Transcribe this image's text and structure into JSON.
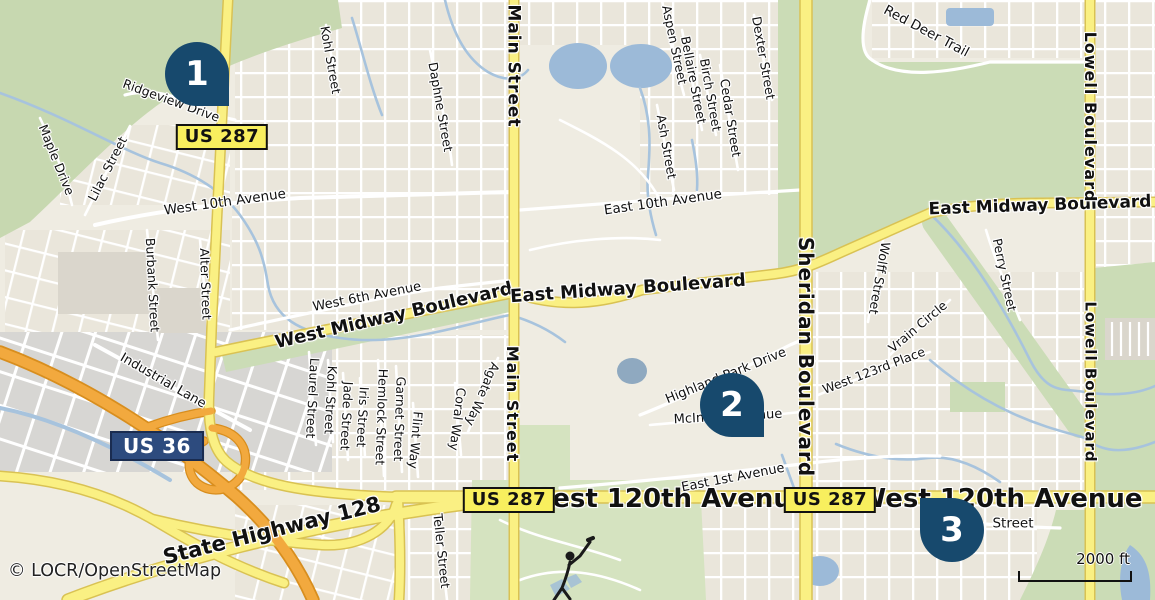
{
  "map": {
    "attribution": "© LOCR/OpenStreetMap",
    "scale_bar": {
      "label": "2000 ft"
    },
    "icons": {
      "golfer": "golfer-silhouette"
    },
    "colors": {
      "land": "#EFECE2",
      "forest": "#C7D8B0",
      "park": "#CBDCB6",
      "golf": "#D5E3C0",
      "water": "#9CBAD8",
      "stream": "#A7C3DD",
      "road_fill": "#FAF083",
      "road_casing": "#D9C253",
      "freeway_fill": "#F2A93E",
      "freeway_casing": "#D88E1E",
      "minor_road": "#FFFFFF",
      "industrial": "#D7D6D3",
      "building": "#DAD6CC",
      "marker": "#17496D",
      "marker_text": "#FFFFFF",
      "shield_yellow_bg": "#F8EF5E",
      "shield_yellow_border": "#111111",
      "shield_yellow_text": "#111111",
      "shield_blue_bg": "#2D4B7E",
      "shield_blue_border": "#1A2C50",
      "shield_blue_text": "#FFFFFF",
      "label": "#111111",
      "halo": "#FFFFFF",
      "attribution": "#222222"
    },
    "markers": [
      {
        "number": "1",
        "x": 197,
        "y": 74,
        "tail": "bottom-right"
      },
      {
        "number": "2",
        "x": 732,
        "y": 405,
        "tail": "bottom-right"
      },
      {
        "number": "3",
        "x": 952,
        "y": 530,
        "tail": "top-left"
      }
    ],
    "shields": [
      {
        "text": "US 287",
        "type": "us-287",
        "x": 222,
        "y": 137
      },
      {
        "text": "US 36",
        "type": "us-36",
        "x": 157,
        "y": 446
      },
      {
        "text": "US 287",
        "type": "us-287",
        "x": 509,
        "y": 500
      },
      {
        "text": "US 287",
        "type": "us-287",
        "x": 830,
        "y": 500
      }
    ],
    "labels": [
      {
        "text": "West 120th Avenue",
        "x": 667,
        "y": 499,
        "r": 0,
        "s": 26,
        "w": 700
      },
      {
        "text": "West 120th Avenue",
        "x": 1000,
        "y": 499,
        "r": 0,
        "s": 26,
        "w": 700
      },
      {
        "text": "State Highway 128",
        "x": 272,
        "y": 531,
        "r": -14,
        "s": 21,
        "w": 700
      },
      {
        "text": "West Midway Boulevard",
        "x": 394,
        "y": 316,
        "r": -13,
        "s": 18,
        "w": 600
      },
      {
        "text": "East Midway Boulevard",
        "x": 628,
        "y": 289,
        "r": -4,
        "s": 18,
        "w": 600
      },
      {
        "text": "East Midway Boulevard",
        "x": 1040,
        "y": 206,
        "r": -2,
        "s": 17,
        "w": 600
      },
      {
        "text": "Main Street",
        "x": 513,
        "y": 66,
        "r": 90,
        "s": 17,
        "w": 600,
        "ls": 1
      },
      {
        "text": "Main Street",
        "x": 512,
        "y": 404,
        "r": 90,
        "s": 16,
        "w": 600,
        "ls": 1
      },
      {
        "text": "Sheridan Boulevard",
        "x": 806,
        "y": 357,
        "r": 90,
        "s": 20,
        "w": 700,
        "ls": 1
      },
      {
        "text": "Lowell Boulevard",
        "x": 1090,
        "y": 117,
        "r": 90,
        "s": 16,
        "w": 600,
        "ls": 1
      },
      {
        "text": "Lowell Boulevard",
        "x": 1090,
        "y": 382,
        "r": 90,
        "s": 15,
        "w": 600,
        "ls": 1
      },
      {
        "text": "Ridgeview Drive",
        "x": 171,
        "y": 101,
        "r": 20,
        "s": 12.5
      },
      {
        "text": "Maple Drive",
        "x": 56,
        "y": 160,
        "r": 68,
        "s": 12.5
      },
      {
        "text": "Lilac Street",
        "x": 108,
        "y": 169,
        "r": -63,
        "s": 12.5
      },
      {
        "text": "West 10th Avenue",
        "x": 225,
        "y": 203,
        "r": -8,
        "s": 13.5
      },
      {
        "text": "Kohl Street",
        "x": 330,
        "y": 60,
        "r": 80,
        "s": 12.5
      },
      {
        "text": "Daphne Street",
        "x": 440,
        "y": 107,
        "r": 80,
        "s": 12.5
      },
      {
        "text": "Aspen Street",
        "x": 674,
        "y": 45,
        "r": 78,
        "s": 12.5
      },
      {
        "text": "Bellaire Street",
        "x": 693,
        "y": 80,
        "r": 79,
        "s": 12.5
      },
      {
        "text": "Birch Street",
        "x": 710,
        "y": 95,
        "r": 80,
        "s": 12.5
      },
      {
        "text": "Cedar Street",
        "x": 730,
        "y": 118,
        "r": 81,
        "s": 12.5
      },
      {
        "text": "Dexter Street",
        "x": 763,
        "y": 58,
        "r": 80,
        "s": 12.5
      },
      {
        "text": "Ash Street",
        "x": 666,
        "y": 147,
        "r": 80,
        "s": 12.5
      },
      {
        "text": "East 10th Avenue",
        "x": 663,
        "y": 203,
        "r": -8,
        "s": 13.5
      },
      {
        "text": "Red Deer Trail",
        "x": 926,
        "y": 32,
        "r": 28,
        "s": 13.5
      },
      {
        "text": "Perry Street",
        "x": 1004,
        "y": 275,
        "r": 78,
        "s": 12.5
      },
      {
        "text": "Wolff Street",
        "x": 879,
        "y": 278,
        "r": 100,
        "s": 12.5
      },
      {
        "text": "Vrain Circle",
        "x": 918,
        "y": 327,
        "r": -40,
        "s": 12.5
      },
      {
        "text": "West 123rd Place",
        "x": 874,
        "y": 371,
        "r": -21,
        "s": 12.5
      },
      {
        "text": "West 6th Avenue",
        "x": 367,
        "y": 297,
        "r": -11,
        "s": 13
      },
      {
        "text": "Burbank Street",
        "x": 152,
        "y": 285,
        "r": 87,
        "s": 12.5
      },
      {
        "text": "Alter Street",
        "x": 205,
        "y": 284,
        "r": 88,
        "s": 12.5
      },
      {
        "text": "Industrial Lane",
        "x": 163,
        "y": 381,
        "r": 30,
        "s": 13
      },
      {
        "text": "Laurel Street",
        "x": 312,
        "y": 398,
        "r": 93,
        "s": 12.5
      },
      {
        "text": "Kohl Street",
        "x": 330,
        "y": 400,
        "r": 93,
        "s": 12.5
      },
      {
        "text": "Jade Street",
        "x": 346,
        "y": 416,
        "r": 93,
        "s": 12.5
      },
      {
        "text": "Iris Street",
        "x": 362,
        "y": 417,
        "r": 93,
        "s": 12.5
      },
      {
        "text": "Hemlock Street",
        "x": 381,
        "y": 417,
        "r": 92,
        "s": 12.5
      },
      {
        "text": "Garnet Street",
        "x": 399,
        "y": 419,
        "r": 92,
        "s": 12.5
      },
      {
        "text": "Flint Way",
        "x": 415,
        "y": 440,
        "r": 95,
        "s": 12.5
      },
      {
        "text": "Coral Way",
        "x": 457,
        "y": 419,
        "r": 97,
        "s": 12.5
      },
      {
        "text": "Agate Way",
        "x": 482,
        "y": 394,
        "r": 113,
        "s": 12.5
      },
      {
        "text": "Teller Street",
        "x": 441,
        "y": 551,
        "r": 84,
        "s": 12.5
      },
      {
        "text": "Highland Park Drive",
        "x": 726,
        "y": 376,
        "r": -22,
        "s": 13
      },
      {
        "text": "McIntyre Avenue",
        "x": 728,
        "y": 417,
        "r": -3,
        "s": 13
      },
      {
        "text": "East 1st Avenue",
        "x": 733,
        "y": 478,
        "r": -11,
        "s": 13
      },
      {
        "text": "Street",
        "x": 1013,
        "y": 524,
        "r": 0,
        "s": 13.5
      }
    ]
  }
}
